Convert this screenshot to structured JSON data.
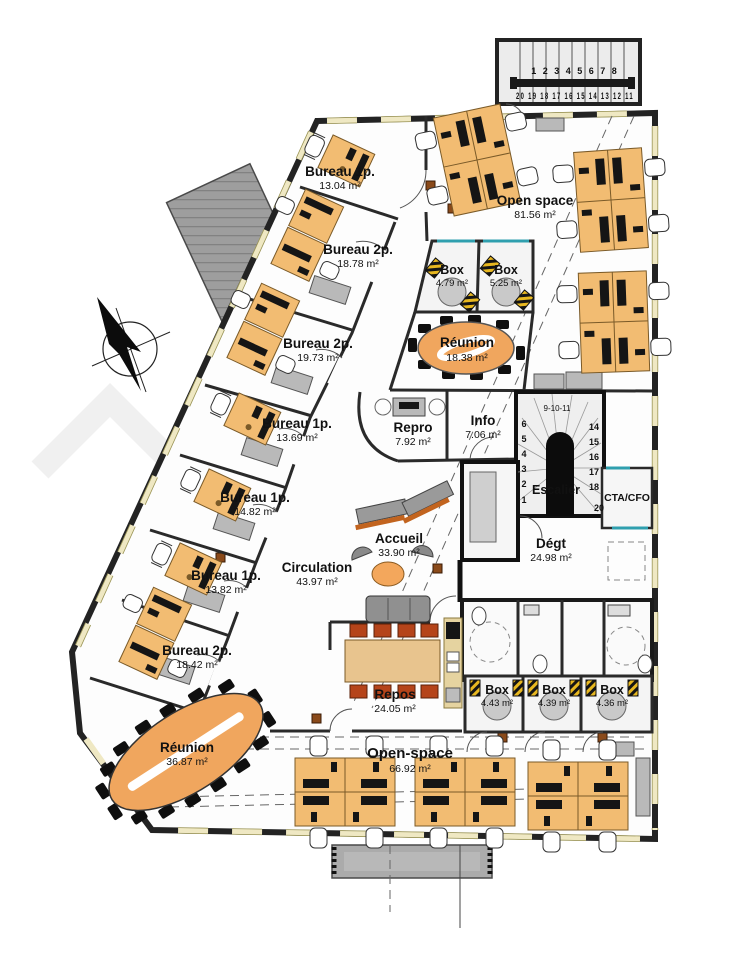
{
  "drawing": {
    "type": "architectural-floor-plan",
    "colors": {
      "desk": "#f2bc72",
      "meeting_table": "#f0a65e",
      "wall": "#232323",
      "window_strip": "#efe8c3",
      "glazing_teal": "#2f9fae",
      "repos_chair": "#b5441a",
      "cabinet_gray": "#b9b9b9",
      "canopy_gray": "#a8a8a8"
    },
    "icons": {
      "compass": "north-arrow"
    }
  },
  "rooms": [
    {
      "name": "Bureau 1p.",
      "area": "13.04 m²"
    },
    {
      "name": "Bureau 2p.",
      "area": "18.78 m²"
    },
    {
      "name": "Bureau 2p.",
      "area": "19.73 m²"
    },
    {
      "name": "Bureau 1p.",
      "area": "13.69 m²"
    },
    {
      "name": "Bureau 1p.",
      "area": "14.82 m²"
    },
    {
      "name": "Bureau 1p.",
      "area": "13.82 m²"
    },
    {
      "name": "Bureau 2p.",
      "area": "18.42 m²"
    },
    {
      "name": "Open space",
      "area": "81.56 m²"
    },
    {
      "name": "Box",
      "area": "4.79 m²"
    },
    {
      "name": "Box",
      "area": "5.25 m²"
    },
    {
      "name": "Réunion",
      "area": "18.38 m²"
    },
    {
      "name": "Repro",
      "area": "7.92 m²"
    },
    {
      "name": "Info",
      "area": "7.06 m²"
    },
    {
      "name": "Escalier",
      "area": ""
    },
    {
      "name": "CTA/CFO",
      "area": ""
    },
    {
      "name": "Accueil",
      "area": "33.90 m²"
    },
    {
      "name": "Dégt",
      "area": "24.98 m²"
    },
    {
      "name": "Circulation",
      "area": "43.97 m²"
    },
    {
      "name": "Repos",
      "area": "24.05 m²"
    },
    {
      "name": "Box",
      "area": "4.43 m²"
    },
    {
      "name": "Box",
      "area": "4.39 m²"
    },
    {
      "name": "Box",
      "area": "4.36 m²"
    },
    {
      "name": "Réunion",
      "area": "36.87 m²"
    },
    {
      "name": "Open-space",
      "area": "66.92 m²"
    }
  ],
  "stair_exterior": {
    "row_up": "1 2 3 4 5 6 7 8",
    "row_down": "20 19 18 17 16 15 14 13 12 11"
  },
  "stair_interior": {
    "left": [
      "6",
      "5",
      "4",
      "3",
      "2",
      "1"
    ],
    "right": [
      "14",
      "15",
      "16",
      "17",
      "18"
    ],
    "bottom": "20",
    "arc": "9-10-11"
  }
}
